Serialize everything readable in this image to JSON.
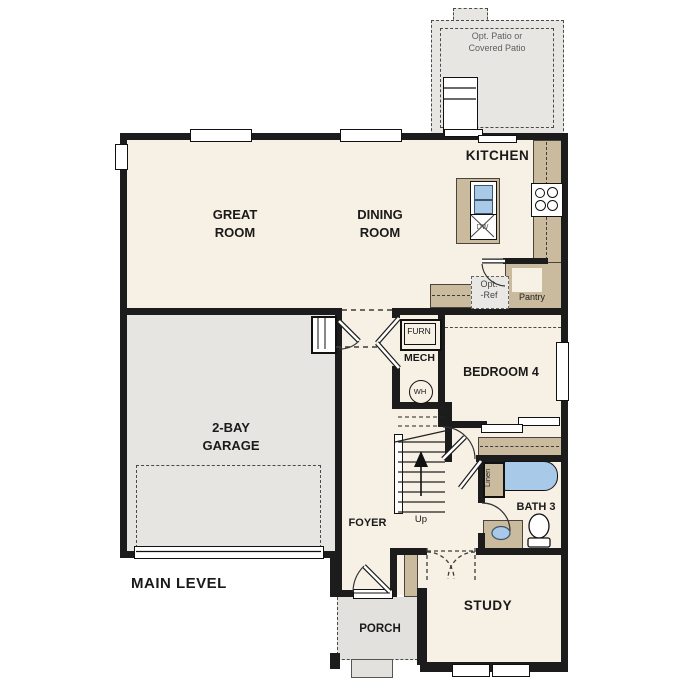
{
  "plan": {
    "level_label": "MAIN LEVEL",
    "rooms": {
      "great_room": "GREAT\nROOM",
      "dining_room": "DINING\nROOM",
      "kitchen": "KITCHEN",
      "garage": "2-BAY\nGARAGE",
      "bedroom4": "BEDROOM 4",
      "mech": "MECH",
      "foyer": "FOYER",
      "bath3": "BATH 3",
      "study": "STUDY",
      "porch": "PORCH"
    },
    "features": {
      "patio": "Opt. Patio or\nCovered Patio",
      "pantry": "Pantry",
      "opt_ref": "Opt.\n-Ref",
      "furnace": "FURN",
      "water_heater": "WH",
      "dishwasher": "DW",
      "linen": "Linen",
      "stairs_up": "Up"
    },
    "colors": {
      "wall": "#1c1c1c",
      "floor": "#f7f0e4",
      "garage_floor": "#e6e5e1",
      "patio_floor": "#e7e6e2",
      "porch_floor": "#e2e1dd",
      "cabinet_tan": "#cbbb9e",
      "fixture_blue": "#a9c9e9",
      "muted_text": "#5f5f5f"
    }
  }
}
